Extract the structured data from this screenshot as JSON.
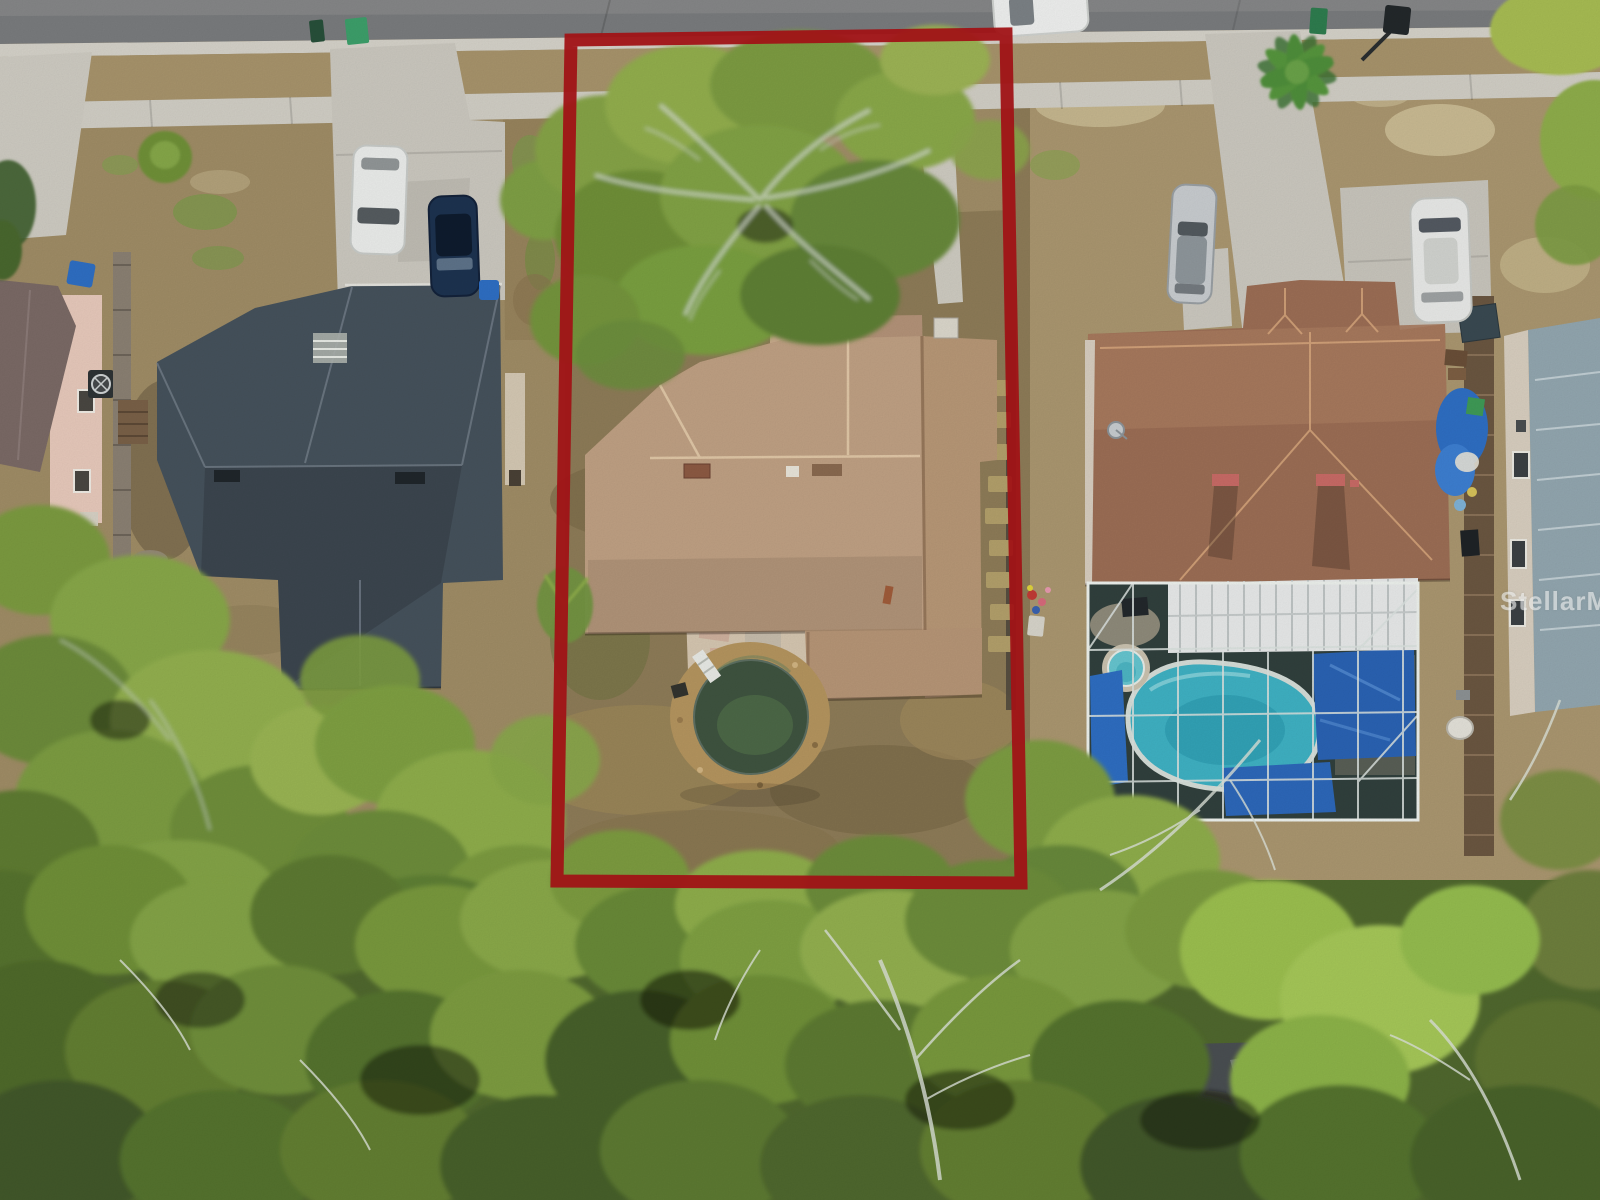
{
  "watermark": {
    "text": "StellarMLS"
  },
  "outline": {
    "color": "#a01316",
    "label": "subject-property-boundary"
  },
  "colors": {
    "road": "#7a7c7e",
    "concrete": "#d2cfc6",
    "left_roof": "#46525c",
    "subject_roof": "#c0a184",
    "right_roof": "#9c6e55",
    "far_right_roof": "#93a7b0",
    "round_pool_water": "#3f5440",
    "pool_rock_ring": "#b5955f",
    "screened_pool_water": "#3fb2c4",
    "spa_water": "#66c6d0",
    "screen_enclosure": "#31403d",
    "lawn": "#a3906a",
    "dirt": "#8e7c58",
    "canopy_green": "#7d9c42",
    "tarp_blue": "#2e6ec2"
  },
  "scene": {
    "objects": [
      "street-road",
      "sidewalk",
      "left-driveway",
      "right-driveway",
      "left-house-dark-roof",
      "subject-house-tan-roof",
      "right-house-brown-roof",
      "far-right-house",
      "pink-house",
      "oak-tree-canopy",
      "bottom-tree-canopy",
      "palm-tree",
      "above-ground-round-pool",
      "screened-pool-enclosure",
      "in-ground-pool",
      "spa",
      "white-car",
      "navy-car",
      "silver-sedan",
      "white-suv",
      "street-parked-car",
      "green-trash-bins",
      "blue-recycle-bins",
      "mailbox",
      "wood-fences",
      "blue-tarps",
      "red-property-outline",
      "mls-watermark"
    ]
  }
}
